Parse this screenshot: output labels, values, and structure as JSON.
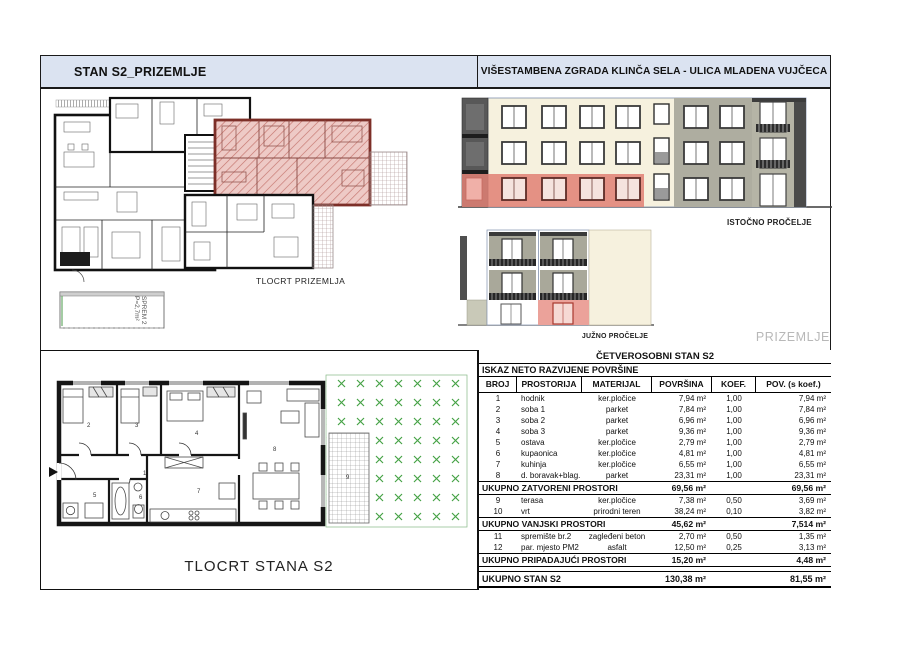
{
  "header": {
    "left_title": "STAN S2_PRIZEMLJE",
    "right_title": "VIŠESTAMBENA ZGRADA KLINČA SELA - ULICA MLADENA VUJČECA"
  },
  "labels": {
    "ground_plan": "TLOCRT PRIZEMLJA",
    "east_facade": "ISTOČNO PROČELJE",
    "south_facade": "JUŽNO PROČELJE",
    "floor_tag": "PRIZEMLJE",
    "apartment_plan": "TLOCRT STANA S2",
    "storage_label": "SPREM 2",
    "storage_area": "P=2,7m²"
  },
  "plan": {
    "room_numbers": [
      "1",
      "2",
      "3",
      "4",
      "5",
      "6",
      "7",
      "8",
      "9"
    ]
  },
  "table": {
    "title": "ČETVEROSOBNI STAN S2",
    "subtitle": "ISKAZ NETO RAZVIJENE POVRŠINE",
    "columns": [
      "BROJ",
      "PROSTORIJA",
      "MATERIJAL",
      "POVRŠINA",
      "KOEF.",
      "POV. (s koef.)"
    ],
    "sections": [
      {
        "rows": [
          [
            "1",
            "hodnik",
            "ker.pločice",
            "7,94 m²",
            "1,00",
            "7,94 m²"
          ],
          [
            "2",
            "soba 1",
            "parket",
            "7,84 m²",
            "1,00",
            "7,84 m²"
          ],
          [
            "3",
            "soba 2",
            "parket",
            "6,96 m²",
            "1,00",
            "6,96 m²"
          ],
          [
            "4",
            "soba 3",
            "parket",
            "9,36 m²",
            "1,00",
            "9,36 m²"
          ],
          [
            "5",
            "ostava",
            "ker.pločice",
            "2,79 m²",
            "1,00",
            "2,79 m²"
          ],
          [
            "6",
            "kupaonica",
            "ker.pločice",
            "4,81 m²",
            "1,00",
            "4,81 m²"
          ],
          [
            "7",
            "kuhinja",
            "ker.pločice",
            "6,55 m²",
            "1,00",
            "6,55 m²"
          ],
          [
            "8",
            "d. boravak+blag.",
            "parket",
            "23,31 m²",
            "1,00",
            "23,31 m²"
          ]
        ],
        "total": [
          "UKUPNO ZATVORENI PROSTORI",
          "69,56 m²",
          "69,56 m²"
        ]
      },
      {
        "rows": [
          [
            "9",
            "terasa",
            "ker.pločice",
            "7,38 m²",
            "0,50",
            "3,69 m²"
          ],
          [
            "10",
            "vrt",
            "prirodni teren",
            "38,24 m²",
            "0,10",
            "3,82 m²"
          ]
        ],
        "total": [
          "UKUPNO VANJSKI PROSTORI",
          "45,62 m²",
          "7,514 m²"
        ]
      },
      {
        "rows": [
          [
            "11",
            "spremište br.2",
            "zagleđeni beton",
            "2,70 m²",
            "0,50",
            "1,35 m²"
          ],
          [
            "12",
            "par. mjesto PM2",
            "asfalt",
            "12,50 m²",
            "0,25",
            "3,13 m²"
          ]
        ],
        "total": [
          "UKUPNO PRIPADAJUĆI PROSTORI",
          "15,20 m²",
          "4,48 m²"
        ]
      }
    ],
    "grand_total": [
      "UKUPNO STAN S2",
      "130,38 m²",
      "81,55 m²"
    ]
  },
  "colors": {
    "header_bg": "#dbe3f1",
    "highlight_red": "#e08074",
    "plan_red_fill": "#eecac6",
    "facade_cream": "#f6f1de",
    "facade_gray": "#aeada0",
    "garden_green": "#46a246",
    "muted_text": "#b8b8b8"
  }
}
